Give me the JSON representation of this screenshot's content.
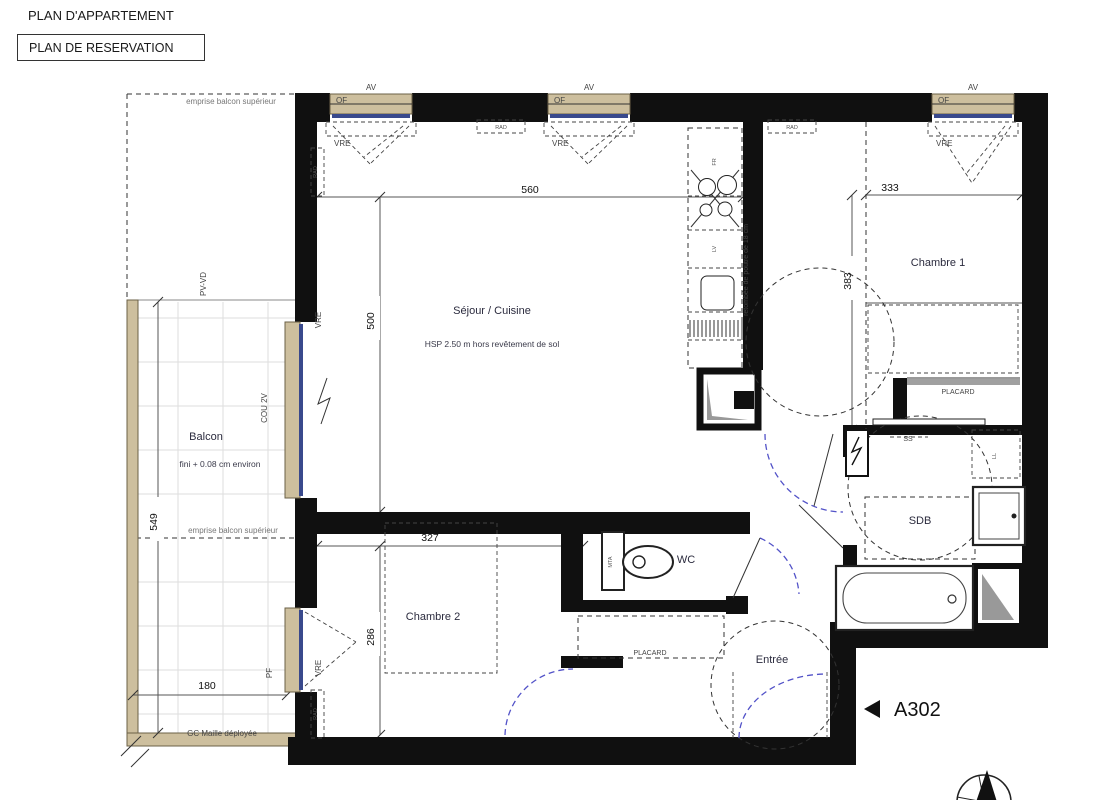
{
  "header": {
    "title": "PLAN D'APPARTEMENT",
    "subtitle": "PLAN DE RESERVATION"
  },
  "rooms": {
    "sejour": {
      "name": "Séjour / Cuisine",
      "note": "HSP 2.50 m hors revêtement de sol"
    },
    "chambre1": {
      "name": "Chambre 1"
    },
    "chambre2": {
      "name": "Chambre 2"
    },
    "balcon": {
      "name": "Balcon",
      "note": "fini + 0.08 cm environ"
    },
    "wc": {
      "name": "WC"
    },
    "sdb": {
      "name": "SDB"
    },
    "entree": {
      "name": "Entrée"
    },
    "placard": {
      "name": "PLACARD"
    }
  },
  "dims": {
    "sejour_w": "560",
    "sejour_h": "500",
    "ch1_w": "333",
    "ch1_h": "383",
    "ch2_w": "327",
    "ch2_h": "286",
    "balcon_h": "549",
    "balcon_w": "180"
  },
  "annotations": {
    "emprise": "emprise balcon supérieur",
    "gc": "GC Maille déployée",
    "beam": "retombée de poutre de 18 cm",
    "unit": "A302"
  },
  "tags": {
    "of": "OF",
    "av": "AV",
    "vre": "VRE",
    "rad": "RAD",
    "ss": "SS",
    "ll": "LL",
    "lv": "LV",
    "fr": "FR",
    "mta": "MTA",
    "pf": "PF",
    "pvvd": "PV-VD",
    "cou": "COU 2V"
  },
  "colors": {
    "wall": "#111111",
    "window_frame": "#cdbf9e",
    "glass": "#39498c",
    "door_arc": "#5252c8",
    "balcony_rail": "#cdbf9e"
  }
}
